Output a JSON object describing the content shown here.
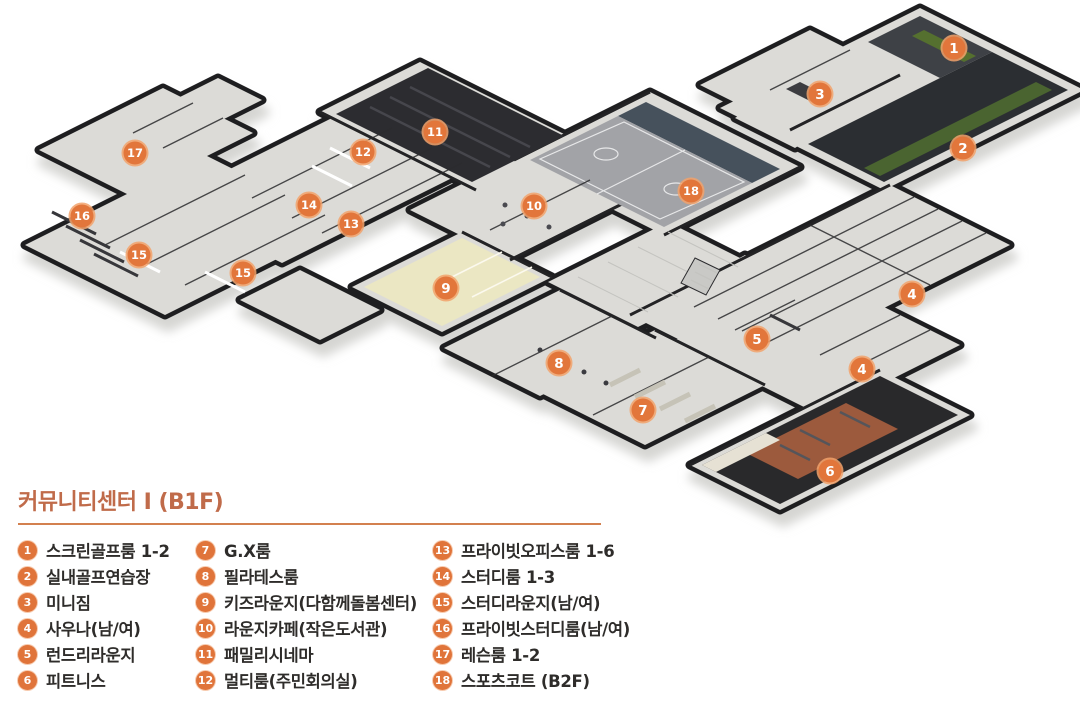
{
  "title": "커뮤니티센터 Ⅰ (B1F)",
  "colors": {
    "title": "#c06b4a",
    "accent": "#d3804f",
    "marker": "#e2763b",
    "marker_halo": "#f2a26b"
  },
  "legend": {
    "columns": [
      {
        "items": [
          {
            "num": "1",
            "label": "스크린골프룸 1-2"
          },
          {
            "num": "2",
            "label": "실내골프연습장"
          },
          {
            "num": "3",
            "label": "미니짐"
          },
          {
            "num": "4",
            "label": "사우나(남/여)"
          },
          {
            "num": "5",
            "label": "런드리라운지"
          },
          {
            "num": "6",
            "label": "피트니스"
          }
        ]
      },
      {
        "items": [
          {
            "num": "7",
            "label": "G.X룸"
          },
          {
            "num": "8",
            "label": "필라테스룸"
          },
          {
            "num": "9",
            "label": "키즈라운지(다함께돌봄센터)"
          },
          {
            "num": "10",
            "label": "라운지카페(작은도서관)"
          },
          {
            "num": "11",
            "label": "패밀리시네마"
          },
          {
            "num": "12",
            "label": "멀티룸(주민회의실)"
          }
        ]
      },
      {
        "items": [
          {
            "num": "13",
            "label": "프라이빗오피스룸 1-6"
          },
          {
            "num": "14",
            "label": "스터디룸 1-3"
          },
          {
            "num": "15",
            "label": "스터디라운지(남/여)"
          },
          {
            "num": "16",
            "label": "프라이빗스터디룸(남/여)"
          },
          {
            "num": "17",
            "label": "레슨룸 1-2"
          },
          {
            "num": "18",
            "label": "스포츠코트 (B2F)"
          }
        ]
      }
    ]
  },
  "plan": {
    "markers": [
      {
        "num": "1",
        "x": 954,
        "y": 48
      },
      {
        "num": "2",
        "x": 963,
        "y": 148
      },
      {
        "num": "3",
        "x": 820,
        "y": 94
      },
      {
        "num": "4",
        "x": 912,
        "y": 294
      },
      {
        "num": "4",
        "x": 862,
        "y": 369
      },
      {
        "num": "5",
        "x": 757,
        "y": 339
      },
      {
        "num": "6",
        "x": 830,
        "y": 471
      },
      {
        "num": "7",
        "x": 643,
        "y": 410
      },
      {
        "num": "8",
        "x": 559,
        "y": 363
      },
      {
        "num": "9",
        "x": 446,
        "y": 288
      },
      {
        "num": "10",
        "x": 534,
        "y": 206
      },
      {
        "num": "11",
        "x": 435,
        "y": 132
      },
      {
        "num": "12",
        "x": 363,
        "y": 152
      },
      {
        "num": "13",
        "x": 351,
        "y": 224
      },
      {
        "num": "14",
        "x": 309,
        "y": 205
      },
      {
        "num": "15",
        "x": 139,
        "y": 255
      },
      {
        "num": "15",
        "x": 243,
        "y": 273
      },
      {
        "num": "16",
        "x": 82,
        "y": 216
      },
      {
        "num": "17",
        "x": 135,
        "y": 153
      },
      {
        "num": "18",
        "x": 691,
        "y": 191
      }
    ]
  }
}
